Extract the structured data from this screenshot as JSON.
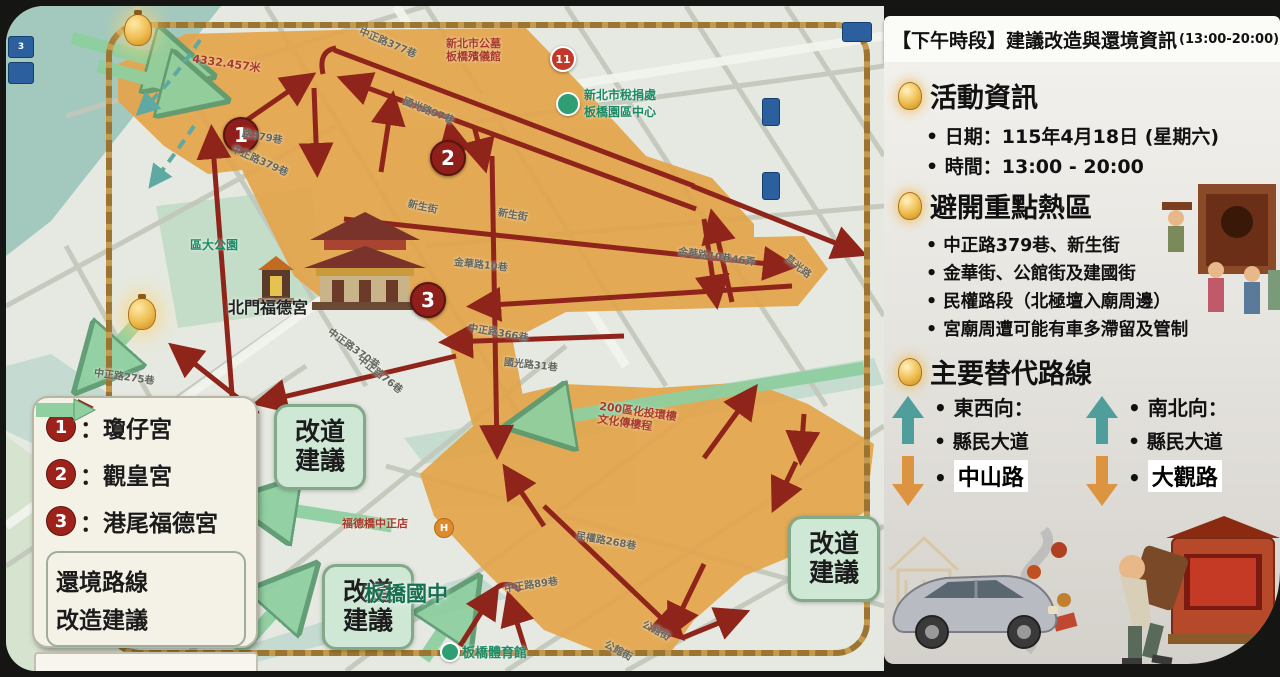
{
  "header": {
    "bracket": "【下午時段】",
    "title": "建議改造與還境資訊",
    "time": "(13:00-20:00)"
  },
  "sidebar": {
    "section1": {
      "title": "活動資訊",
      "date": "日期：115年4月18日 (星期六)",
      "time": "時間：13:00 - 20:00"
    },
    "section2": {
      "title": "避開重點熱區",
      "b1": "中正路379巷、新生街",
      "b2": "金華街、公館街及建國街",
      "b3": "民權路段（北極壇入廟周邊）",
      "b4": "宮廟周遭可能有車多滯留及管制"
    },
    "section3": {
      "title": "主要替代路線",
      "col1": {
        "heading": "東西向：",
        "route": "縣民大道",
        "highlight": "中山路"
      },
      "col2": {
        "heading": "南北向：",
        "route": "縣民大道",
        "highlight": "大觀路"
      }
    }
  },
  "legend": {
    "items": [
      {
        "num": "1",
        "name": "：瓊仔宮"
      },
      {
        "num": "2",
        "name": "：觀皇宮"
      },
      {
        "num": "3",
        "name": "：港尾福德宮"
      }
    ],
    "route_label": "還境路線",
    "detour_label": "改造建議"
  },
  "map": {
    "detour_line1": "改道",
    "detour_line2": "建議",
    "markers": {
      "m1": "1",
      "m2": "2",
      "m3": "3"
    },
    "distance_note": "4332.457米",
    "street_labels": [
      "中正路377巷",
      "國光路97巷",
      "路379巷",
      "中正路379巷",
      "新生街",
      "新生街",
      "金華路10巷",
      "金華路10巷46弄",
      "中正路366巷",
      "國光路31巷",
      "中正路370巷",
      "中正路76巷",
      "中正路275巷",
      "民權路268巷",
      "中正路89巷",
      "中正路89巷",
      "公館街",
      "公館街",
      "莒光路"
    ],
    "landmarks": {
      "funeral_line1": "新北市公墓",
      "funeral_line2": "板橋殯儀館",
      "funeral_pin": "11",
      "tax_line1": "新北市稅捐處",
      "tax_line2": "板橋園區中心",
      "north_gate_temple": "北門福德宮",
      "park": "區大公園",
      "school": "板橋國中",
      "gym": "板橋體育館",
      "store": "福德橋中正店",
      "store_pin": "H",
      "block_line1": "200區化投環樓",
      "block_line2": "文化傳樓程"
    },
    "colors": {
      "zone_orange": "#e3a54b",
      "route_red": "#8f241b",
      "detour_green": "#8fcfa0",
      "alt_up_teal": "#4f9e9b",
      "alt_down_orange": "#dd9440",
      "rope_gold": "#c49b4e"
    }
  }
}
